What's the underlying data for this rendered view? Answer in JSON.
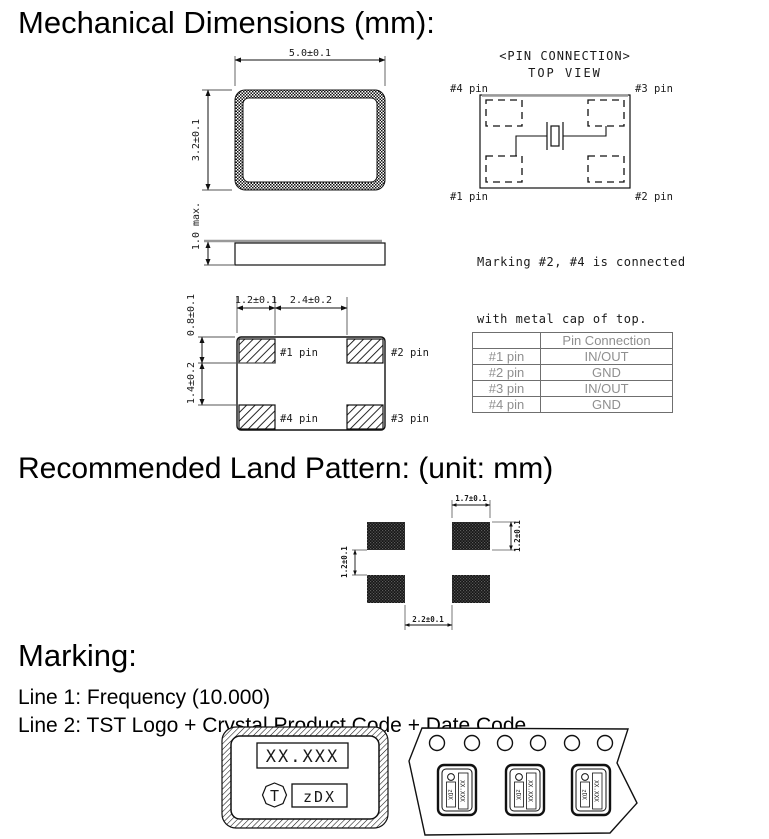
{
  "sections": {
    "mechanical_title": "Mechanical Dimensions (mm):",
    "land_pattern_title": "Recommended Land Pattern: (unit: mm)",
    "marking_title": "Marking:",
    "marking_line1": "Line 1: Frequency (10.000)",
    "marking_line2": "Line 2: TST Logo + Crystal Product Code + Date Code"
  },
  "top_view": {
    "width_dim": "5.0±0.1",
    "height_dim": "3.2±0.1",
    "thickness_dim": "1.0 max."
  },
  "pin_connection": {
    "title": "<PIN CONNECTION>",
    "subtitle": "TOP VIEW",
    "pin1_label": "#1 pin",
    "pin2_label": "#2 pin",
    "pin3_label": "#3 pin",
    "pin4_label": "#4 pin",
    "note_line1": "Marking #2, #4 is connected",
    "note_line2": "with metal cap of top."
  },
  "bottom_view": {
    "pad_width_dim": "1.2±0.1",
    "pad_gap_dim": "2.4±0.2",
    "pad_height_dim": "0.8±0.1",
    "pad_row_gap_dim": "1.4±0.2",
    "pin1_label": "#1 pin",
    "pin2_label": "#2 pin",
    "pin3_label": "#3 pin",
    "pin4_label": "#4 pin"
  },
  "pin_table": {
    "header": [
      "",
      "Pin Connection"
    ],
    "rows": [
      [
        "#1 pin",
        "IN/OUT"
      ],
      [
        "#2 pin",
        "GND"
      ],
      [
        "#3 pin",
        "IN/OUT"
      ],
      [
        "#4 pin",
        "GND"
      ]
    ]
  },
  "land_pattern": {
    "pad_width_dim": "1.7±0.1",
    "pad_height_dim": "1.2±0.1",
    "row_gap_dim": "1.2±0.1",
    "col_gap_dim": "2.2±0.1"
  },
  "marking_example": {
    "frequency_text": "XX.XXX",
    "logo_letter": "T",
    "product_code": "zDX"
  },
  "tape_example": {
    "frequency_text": "XX.XXX",
    "product_code": "zDX"
  },
  "colors": {
    "ink": "#1a1a1a",
    "table_text": "#8f8f8f",
    "table_border": "#6f6f6f",
    "lid_gray": "#999999"
  }
}
